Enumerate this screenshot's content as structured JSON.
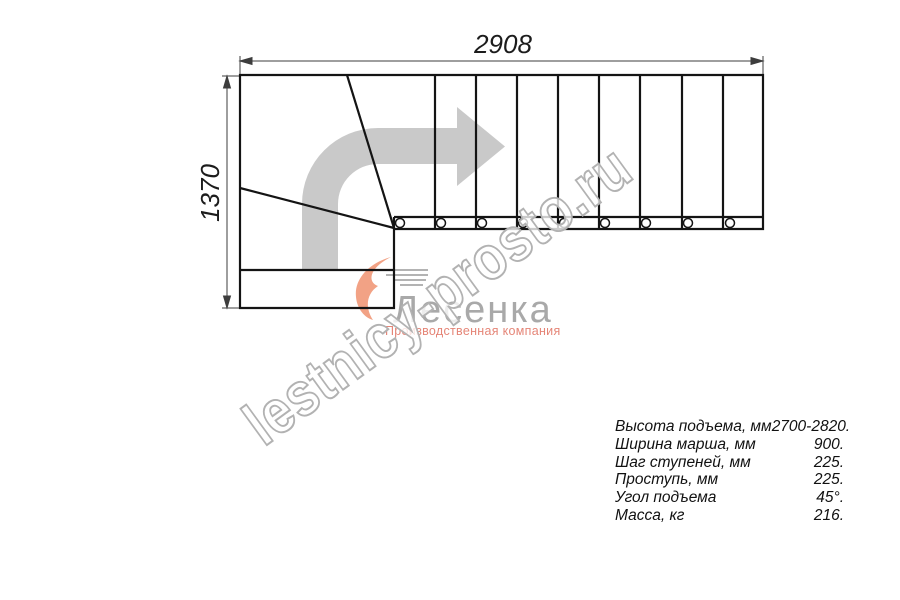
{
  "drawing": {
    "title": "staircase-plan-top-view",
    "width_dim": "2908",
    "height_dim": "1370"
  },
  "watermark": "lestnicy-prosto.ru",
  "logo": {
    "name": "Лесенка",
    "tagline": "Производственная компания"
  },
  "specs": {
    "rows": [
      {
        "label": "Высота подъема, мм",
        "value": "2700-2820."
      },
      {
        "label": "Ширина марша, мм",
        "value": "900."
      },
      {
        "label": "Шаг ступеней, мм",
        "value": "225."
      },
      {
        "label": "Проступь, мм",
        "value": "225."
      },
      {
        "label": "Угол подъема",
        "value": "45°."
      },
      {
        "label": "Масса, кг",
        "value": "216."
      }
    ]
  },
  "colors": {
    "plan_lines": "#141414",
    "dimension_lines": "#3d3d3d",
    "direction_arrow": "#c9c9c9",
    "logo_accent": "#f2a285",
    "logo_gray": "#a9a9a9",
    "tagline_orange": "#e58577",
    "watermark_stroke": "#b2b2b2"
  }
}
